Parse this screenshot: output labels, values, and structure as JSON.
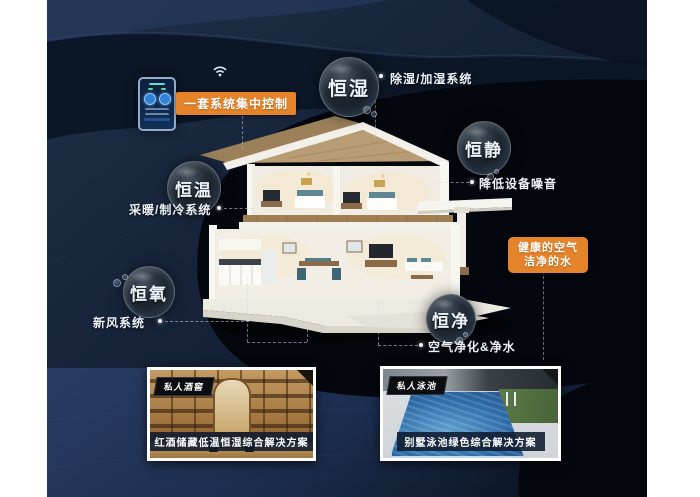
{
  "scene": {
    "colors": {
      "accent": "#e5832b",
      "background_navy": "#152238",
      "panel_black": "#04070d"
    },
    "control": {
      "badge": "一套系统集中控制"
    },
    "callouts": {
      "humidity": {
        "bubble": "恒湿",
        "label": "除湿/加湿系统"
      },
      "quiet": {
        "bubble": "恒静",
        "label": "降低设备噪音"
      },
      "temperature": {
        "bubble": "恒温",
        "label": "采暖/制冷系统"
      },
      "oxygen": {
        "bubble": "恒氧",
        "label": "新风系统"
      },
      "purity": {
        "bubble": "恒净",
        "label": "空气净化&净水"
      }
    },
    "highlight": {
      "line1": "健康的空气",
      "line2": "洁净的水"
    },
    "solutions": {
      "wine": {
        "tag": "私人酒窖",
        "caption": "红酒储藏低温恒湿综合解决方案"
      },
      "pool": {
        "tag": "私人泳池",
        "caption": "别墅泳池绿色综合解决方案"
      }
    }
  }
}
